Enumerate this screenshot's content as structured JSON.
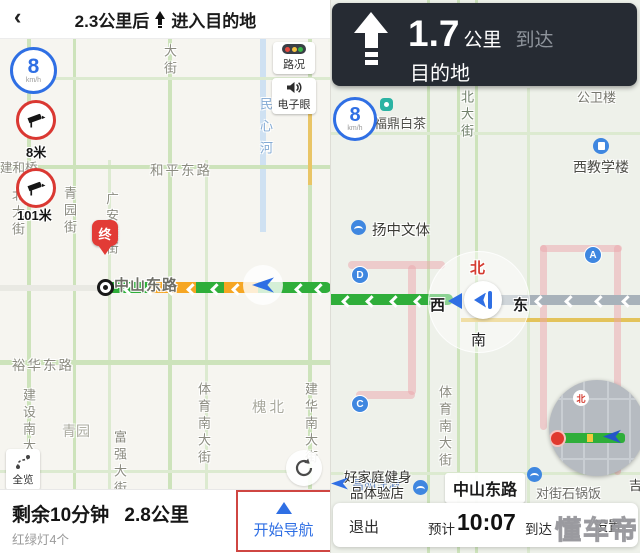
{
  "watermark": "懂车帝",
  "colors": {
    "accent_blue": "#2f6fe4",
    "route_green": "#2fae3a",
    "route_amber": "#f6a623",
    "camera_red": "#da3832",
    "banner_bg": "#262b33",
    "highlight_red": "#cf4642"
  },
  "left": {
    "header": {
      "title_distance": "2.3公里后",
      "title_action": "进入目的地"
    },
    "speed": {
      "value": "8",
      "unit": "km/h"
    },
    "camera1": {
      "distance": "8米"
    },
    "camera2": {
      "distance": "101米"
    },
    "traffic_button": "路况",
    "ecam_button": "电子眼",
    "overview_button": "全览",
    "pin": "终",
    "labels": {
      "dajie": "大街",
      "shen": "神",
      "jianheqiao": "建和桥",
      "beidajie": "北大街",
      "qingyuanjie": "青园街",
      "guangandajie": "广安大街",
      "hepingdonglu": "和平东路",
      "minxinhe": "民心河",
      "zhongshandonglu": "中山东路",
      "yuhuadonglu": "裕华东路",
      "jianshenandajie": "建设南大街",
      "qingyuan": "青园",
      "fuqiangdajie": "富强大街",
      "tiyunandajie": "体育南大街",
      "huaibei": "槐北",
      "jianhuanandajie": "建华南大街"
    },
    "bottom": {
      "remaining_time": "剩余10分钟",
      "remaining_distance": "2.8公里",
      "traffic_lights": "红绿灯4个",
      "start_nav": "开始导航"
    }
  },
  "right": {
    "banner": {
      "distance_value": "1.7",
      "distance_unit": "公里",
      "arrive": "到达",
      "destination": "目的地"
    },
    "speed": {
      "value": "8",
      "unit": "km/h"
    },
    "compass": {
      "north": "北",
      "south": "南",
      "east": "东",
      "west": "西"
    },
    "stations": {
      "a": "A",
      "c": "C",
      "d": "D"
    },
    "labels": {
      "gongweilou": "公卫楼",
      "xijiaoxuelou": "西教学楼",
      "beidajie": "北大街",
      "fudingbaicha": "福鼎白茶",
      "yangzhongwenti": "扬中文体",
      "tiyunandajie": "体育南大街",
      "jiatingjianshen": "好家庭健身",
      "pintiyandian": "品体验店",
      "changmingyangjiu": "昌明洋酒",
      "duijieshiguofan": "对街石锅饭",
      "ji": "吉",
      "road_pill": "中山东路"
    },
    "minimap": {
      "north": "北"
    },
    "bottom": {
      "exit": "退出",
      "eta_prefix": "预计",
      "eta_time": "10:07",
      "eta_suffix": "到达",
      "settings": "设置"
    }
  }
}
